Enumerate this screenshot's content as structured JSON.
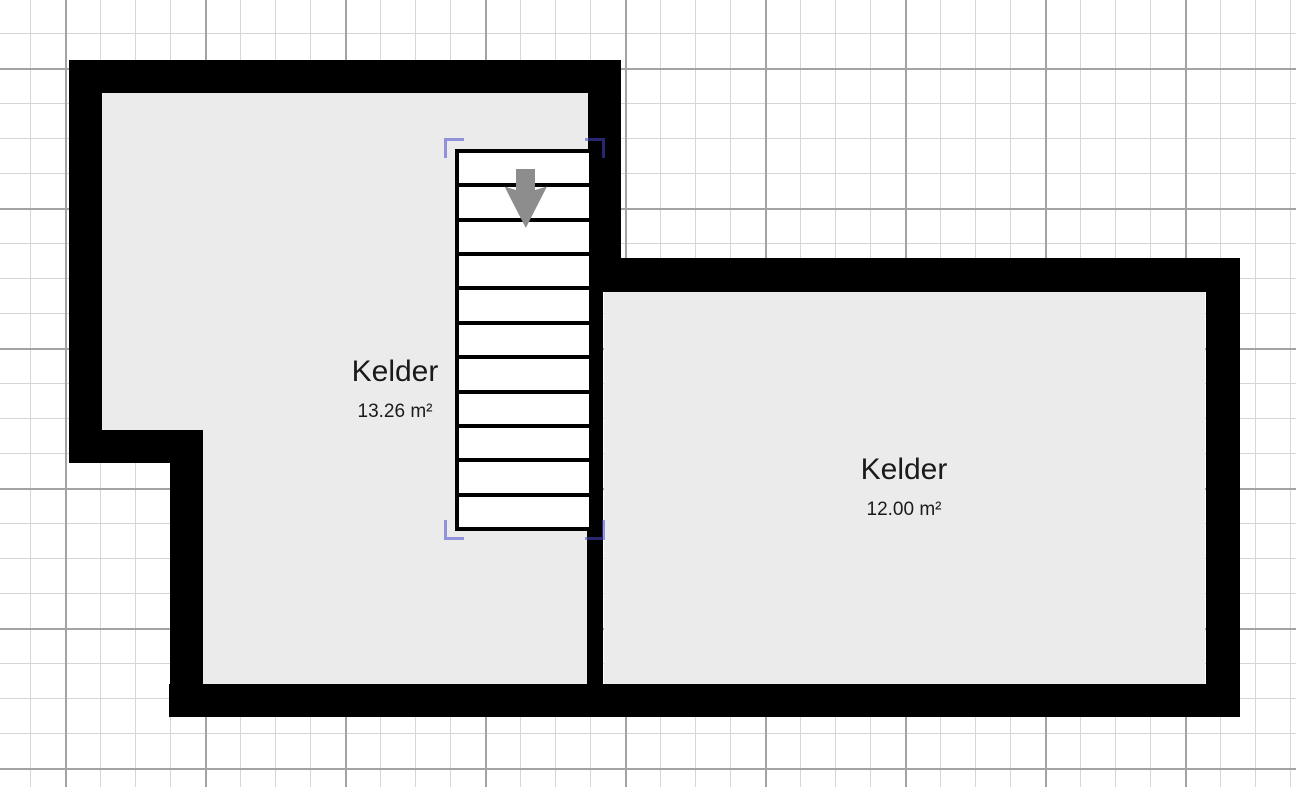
{
  "canvas": {
    "type": "floorplan-editor",
    "background_color": "#ffffff",
    "grid_minor_color": "#d6d6d6",
    "grid_major_color": "#a3a3a3",
    "floor_color": "#ebebeb",
    "wall_color": "#000000"
  },
  "rooms": [
    {
      "name": "Kelder",
      "area": "13.26 m²"
    },
    {
      "name": "Kelder",
      "area": "12.00 m²"
    }
  ],
  "stairs": {
    "steps": 11,
    "direction": "down",
    "arrow_icon": "arrow-down",
    "arrow_color": "#8d8d8d",
    "selected": true,
    "selection_color": "rgba(72,72,204,0.55)"
  }
}
